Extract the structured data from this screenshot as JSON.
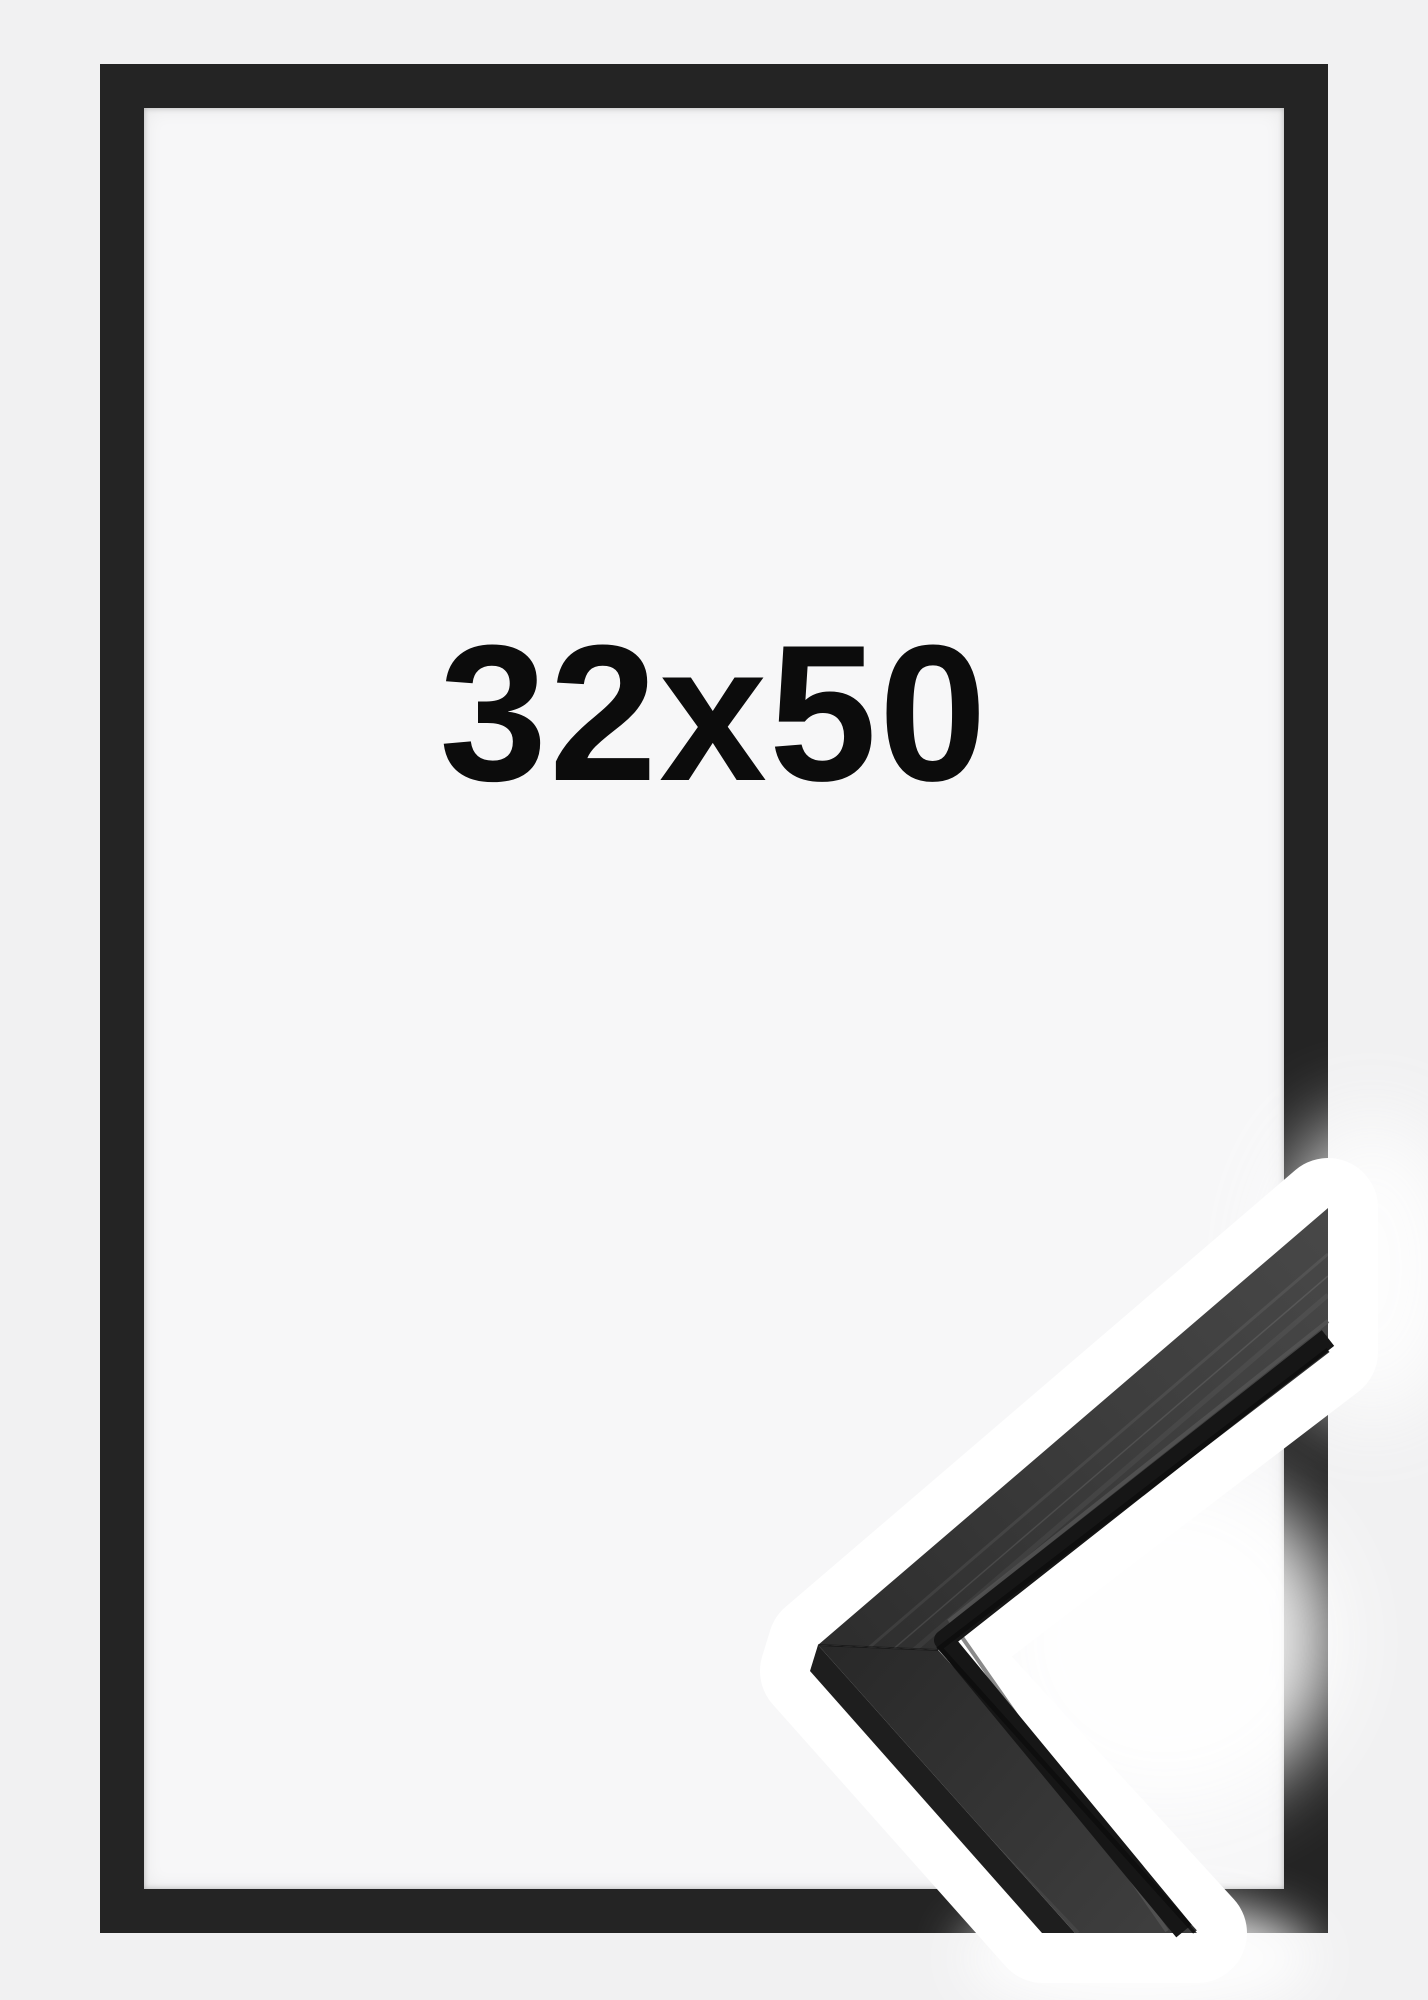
{
  "product_image": {
    "size_label": "32x50",
    "colors": {
      "background": "#f1f1f2",
      "paper": "#f7f7f8",
      "frame_border": "#242424",
      "label_text": "#0c0c0c",
      "moulding_band": "#ffffff",
      "moulding_face_dark": "#2e2e2e",
      "moulding_face_light": "#484848",
      "moulding_groove": "#161616",
      "moulding_side": "#1e1e1e"
    }
  }
}
